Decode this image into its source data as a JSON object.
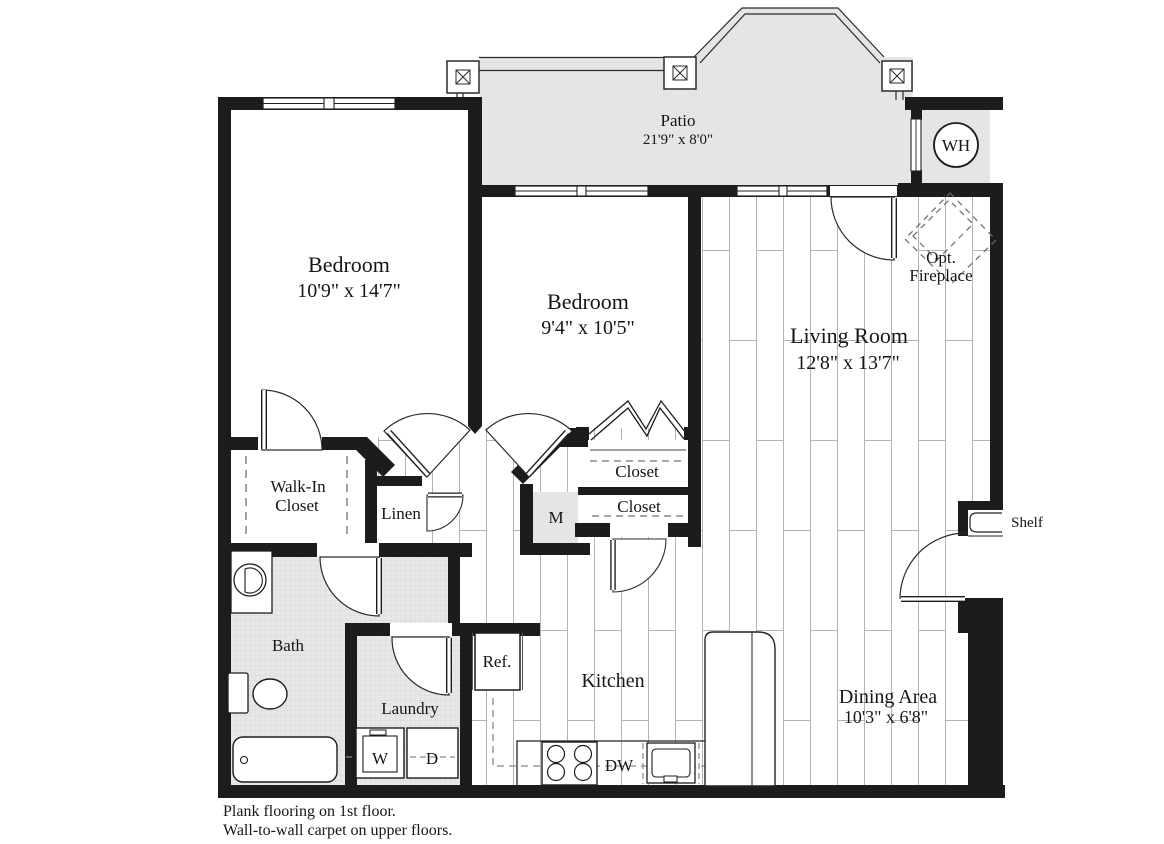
{
  "floor_plan": {
    "rooms": {
      "patio": {
        "name": "Patio",
        "dims": "21'9\" x 8'0\""
      },
      "bedroom1": {
        "name": "Bedroom",
        "dims": "10'9\" x 14'7\""
      },
      "bedroom2": {
        "name": "Bedroom",
        "dims": "9'4\" x 10'5\""
      },
      "living_room": {
        "name": "Living Room",
        "dims": "12'8\" x 13'7\""
      },
      "dining_area": {
        "name": "Dining Area",
        "dims": "10'3\" x 6'8\""
      },
      "kitchen": {
        "name": "Kitchen"
      },
      "bath": {
        "name": "Bath"
      },
      "laundry": {
        "name": "Laundry"
      },
      "walk_in_closet": {
        "name_line1": "Walk-In",
        "name_line2": "Closet"
      },
      "linen_closet": {
        "name": "Linen"
      },
      "hall_closet_upper": {
        "name": "Closet"
      },
      "hall_closet_lower": {
        "name": "Closet"
      }
    },
    "fixtures": {
      "water_heater": "WH",
      "mechanical": "M",
      "refrigerator": "Ref.",
      "dishwasher": "DW",
      "washer": "W",
      "dryer": "D",
      "shelf": "Shelf",
      "opt_fireplace_line1": "Opt.",
      "opt_fireplace_line2": "Fireplace"
    },
    "notes": {
      "line1": "Plank flooring on 1st floor.",
      "line2": "Wall-to-wall carpet on upper floors."
    },
    "colors": {
      "wall": "#1c1c1c",
      "line": "#2a2a2a",
      "patio_floor": "#e5e5e7",
      "tile_floor": "#e7e7e9",
      "plank_line": "#b4b4b8",
      "dash": "#8a8a8a"
    }
  }
}
